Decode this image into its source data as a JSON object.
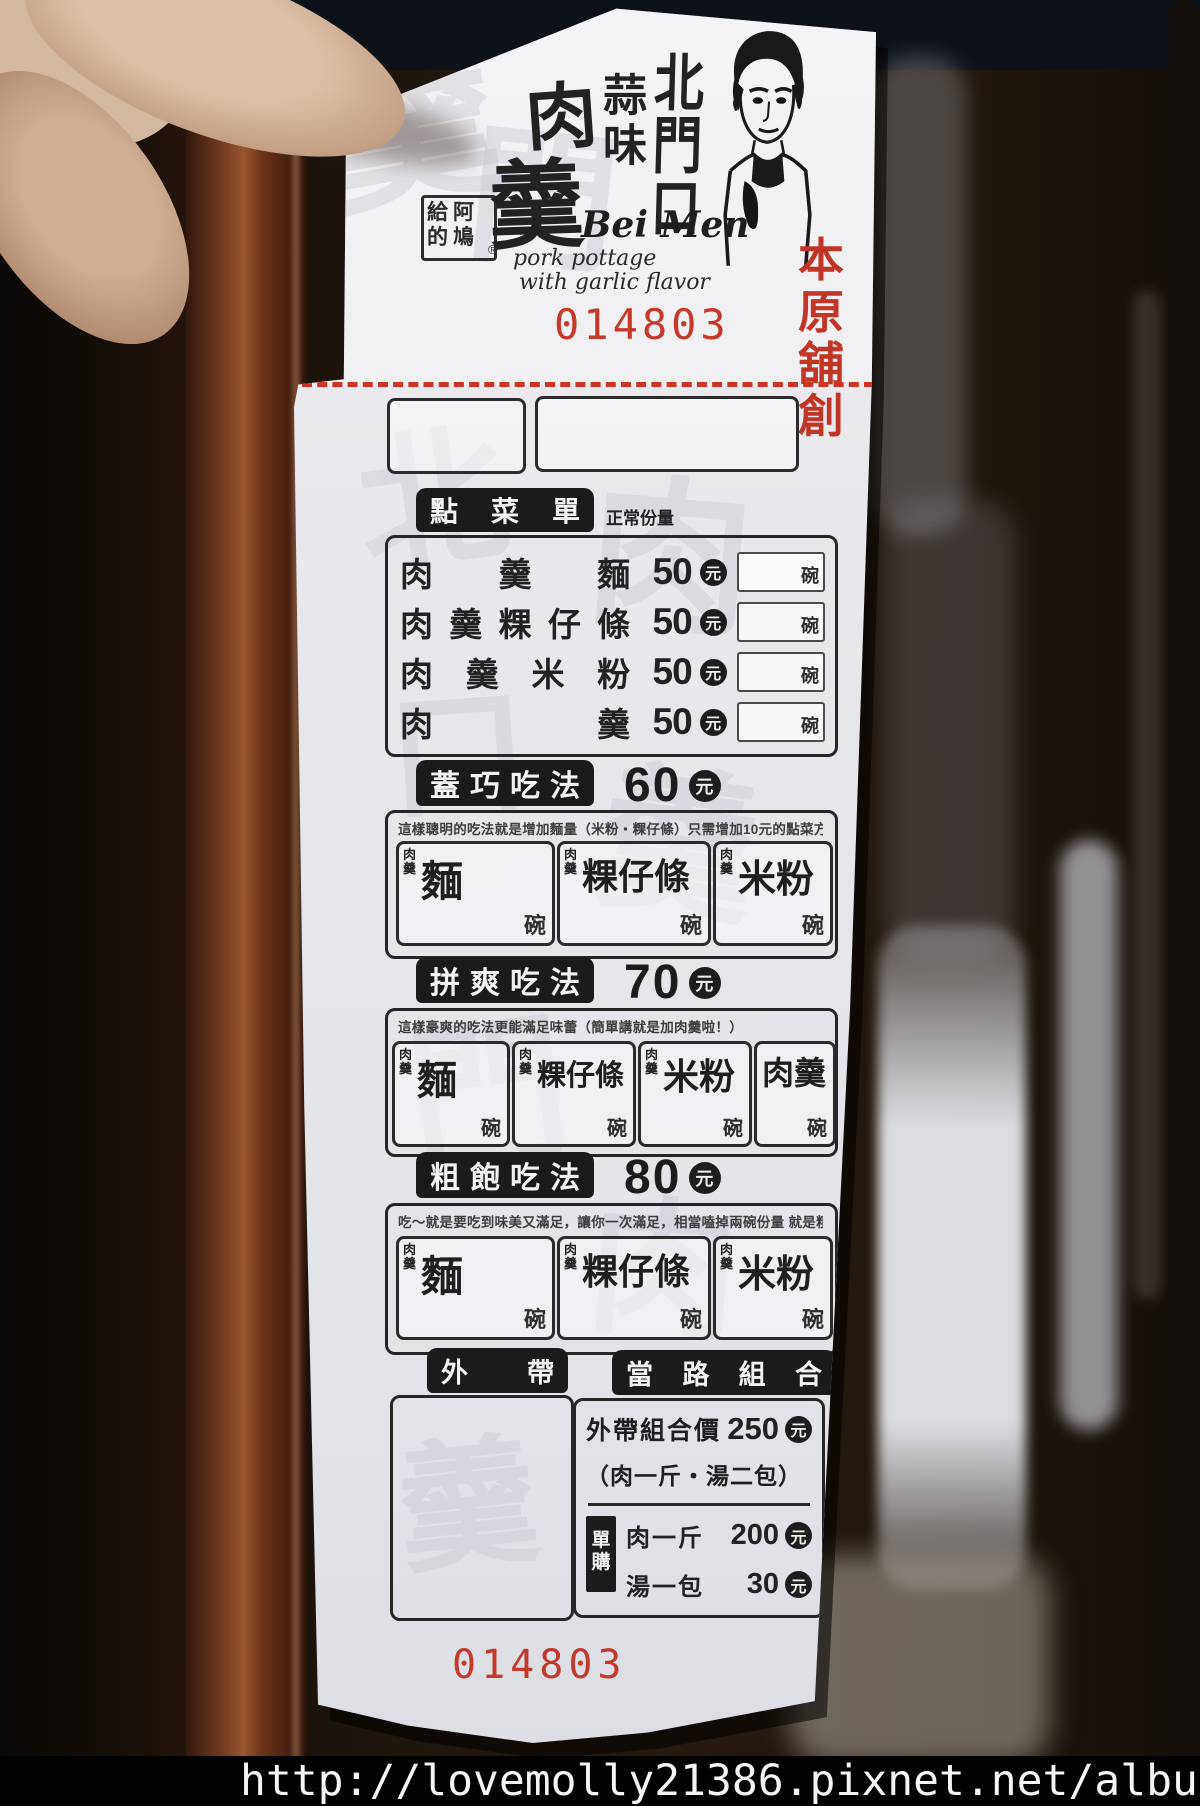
{
  "watermark_bar": {
    "url_text": "http://lovemolly21386.pixnet.net/album"
  },
  "receipt": {
    "brand": {
      "seal_row1": "給阿",
      "seal_row2": "的鳩",
      "registered_mark": "®",
      "name_char1": "肉",
      "name_char2": "羹",
      "flavor_vertical": "蒜味",
      "place_vertical": "北門口",
      "latin_name": "Bei Men",
      "latin_line1": "pork pottage",
      "latin_line2": "with garlic flavor",
      "stamp_row1": "本原",
      "stamp_row2": "舖創",
      "serial_number": "014803"
    },
    "order_menu": {
      "title": "點菜單",
      "portion_note": "正常份量",
      "currency": "元",
      "bowl_unit": "碗",
      "items": [
        {
          "name": "肉羹麵",
          "price": "50"
        },
        {
          "name": "肉羹粿仔條",
          "price": "50"
        },
        {
          "name": "肉羹米粉",
          "price": "50"
        },
        {
          "name": "肉羹",
          "price": "50"
        }
      ]
    },
    "style_sections": [
      {
        "title": "蓋巧吃法",
        "price": "60",
        "currency": "元",
        "bowl_unit": "碗",
        "option_prefix": "肉羹",
        "description": "這樣聰明的吃法就是增加麵量（米粉・粿仔條）只需增加10元的點菜方式！",
        "options": [
          "麵",
          "粿仔條",
          "米粉"
        ]
      },
      {
        "title": "拼爽吃法",
        "price": "70",
        "currency": "元",
        "bowl_unit": "碗",
        "option_prefix": "肉羹",
        "description": "這樣豪爽的吃法更能滿足味蕾（簡單講就是加肉羹啦！）",
        "options": [
          "麵",
          "粿仔條",
          "米粉",
          "肉羹"
        ]
      },
      {
        "title": "粗飽吃法",
        "price": "80",
        "currency": "元",
        "bowl_unit": "碗",
        "option_prefix": "肉羹",
        "description": "吃～就是要吃到味美又滿足，讓你一次滿足，相當嗑掉兩碗份量 就是粗飽啦！",
        "options": [
          "麵",
          "粿仔條",
          "米粉"
        ]
      }
    ],
    "takeout": {
      "title": "外帶",
      "combo_title": "當路組合",
      "combo_price_label": "外帶組合價",
      "combo_price": "250",
      "currency": "元",
      "combo_note": "（肉一斤・湯二包）",
      "single_purchase_label": "單購",
      "single_items": [
        {
          "name": "肉一斤",
          "price": "200"
        },
        {
          "name": "湯一包",
          "price": "30"
        }
      ]
    },
    "bottom_serial": "014803",
    "paper_watermark_chars": [
      "羹",
      "門",
      "北",
      "肉",
      "口",
      "羹",
      "門",
      "肉",
      "羹"
    ]
  }
}
